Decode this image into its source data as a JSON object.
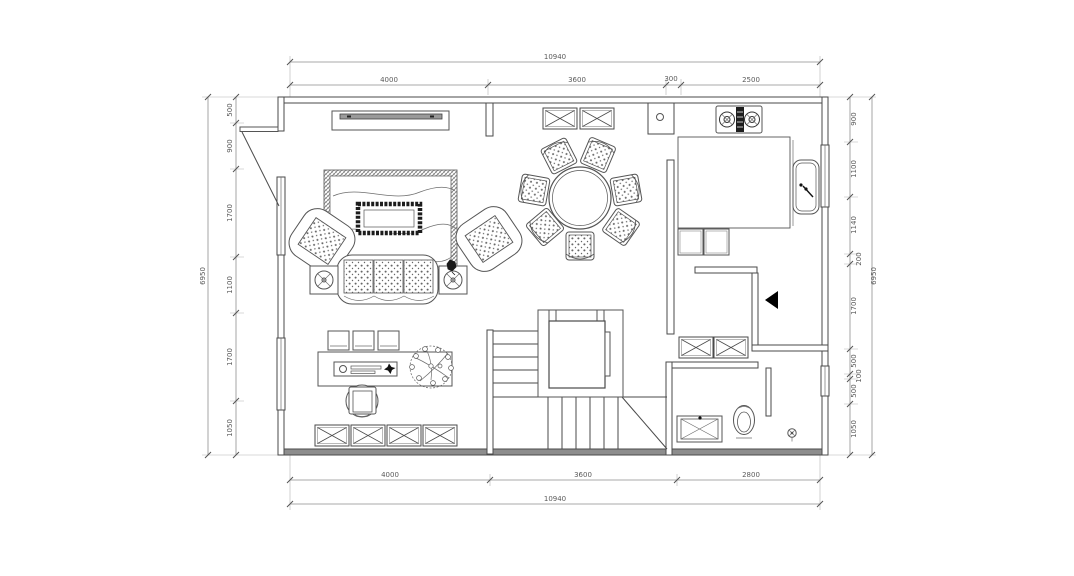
{
  "drawing": {
    "type": "residential floor plan (CAD)",
    "line_color": "#4a4a4a",
    "dim_color": "#5a5a5a",
    "wall_fill": "#8d8d8d",
    "icons": [
      "tv-unit-icon",
      "rug-icon",
      "coffee-table-icon",
      "sofa-icon",
      "armchair-icon",
      "side-table-icon",
      "dining-table-icon",
      "dining-chair-icon",
      "window-box-icon",
      "stove-icon",
      "kitchen-sink-icon",
      "base-cabinet-icon",
      "elevator-icon",
      "stair-treads-icon",
      "direction-arrow-icon",
      "vanity-icon",
      "toilet-icon",
      "floor-drain-icon",
      "desk-icon",
      "desk-chair-icon",
      "plant-icon",
      "entry-door-icon"
    ]
  },
  "dims": {
    "top": {
      "overall": "10940",
      "segments": [
        "4000",
        "3600",
        "300",
        "2500"
      ]
    },
    "bottom": {
      "overall": "10940",
      "segments": [
        "4000",
        "3600",
        "2800"
      ]
    },
    "left": {
      "overall": "6950",
      "segments": [
        "500",
        "900",
        "1700",
        "1100",
        "1700",
        "1050"
      ]
    },
    "right": {
      "overall": "6950",
      "segments": [
        "900",
        "1100",
        "1140",
        "200",
        "1700",
        "500",
        "100",
        "500",
        "1050"
      ]
    }
  }
}
